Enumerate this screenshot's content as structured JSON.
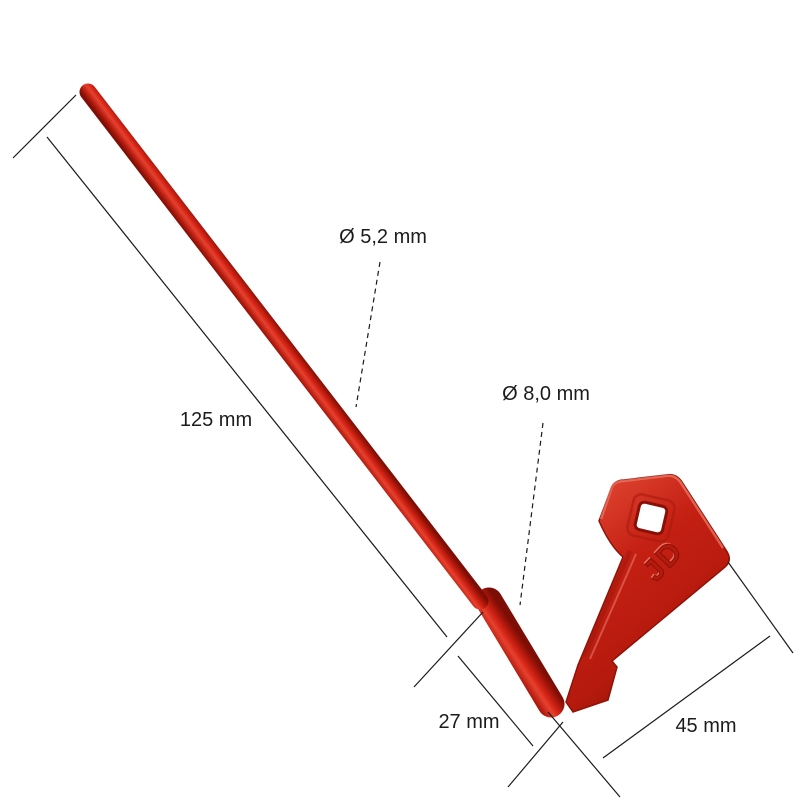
{
  "figure": {
    "type": "dimensioned-product-photo",
    "product": "red plastic fuel/battery key with long rod",
    "logo_text": "JD",
    "colors": {
      "background": "#ffffff",
      "line": "#1a1a1a",
      "key_dark": "#7e0f06",
      "key_mid": "#c42013",
      "key_red": "#d42517",
      "key_highlight": "#e6412e",
      "key_light": "#ef8170"
    }
  },
  "dimensions": {
    "rod_diameter": {
      "label": "Ø 5,2 mm"
    },
    "shaft_diameter": {
      "label": "Ø 8,0 mm"
    },
    "rod_length": {
      "label": "125 mm"
    },
    "shaft_length": {
      "label": "27 mm"
    },
    "head_width": {
      "label": "45 mm"
    }
  }
}
